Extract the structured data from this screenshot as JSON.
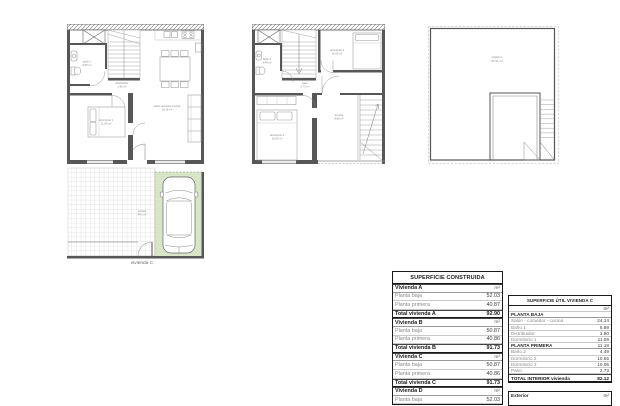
{
  "colors": {
    "wall": "#575757",
    "furniture_line": "#999999",
    "parking_green": "#dbe7cb",
    "label_gray": "#8a8a8a"
  },
  "drawing": {
    "caption": "vivienda C",
    "planta_baja": {
      "bano": [
        "baño 1",
        "5.89 m²"
      ],
      "distribuidor": [
        "distribuidor",
        "1.90 m²"
      ],
      "dormitorio1": [
        "dormitorio 1",
        "11.09 m²"
      ],
      "salon": [
        "salón-comedor-cocina",
        "24.14 m²"
      ]
    },
    "planta_primera": {
      "bano": [
        "baño 2",
        "4.49 m²"
      ],
      "paso": [
        "paso",
        "2.73 m²"
      ],
      "dormitorio3": [
        "dormitorio 3",
        "10.05 m²"
      ],
      "dormitorio2": [
        "dormitorio 2",
        "10.65 m²"
      ],
      "terraza": [
        "terraza",
        "8.86 m²"
      ]
    },
    "solarium": [
      "solárium",
      "31.91 m²"
    ],
    "parcela": [
      "terraza",
      "44.1 m²"
    ]
  },
  "tables": {
    "construida": {
      "title": "SUPERFICIE CONSTRUIDA",
      "unit": "m²",
      "sections": [
        {
          "name": "Vivienda A",
          "rows": [
            {
              "label": "Planta baja",
              "value": "52.03"
            },
            {
              "label": "Planta primera",
              "value": "40.87"
            }
          ],
          "total_label": "Total vivienda A",
          "total_value": "92.90"
        },
        {
          "name": "Vivienda B",
          "rows": [
            {
              "label": "Planta baja",
              "value": "50.87"
            },
            {
              "label": "Planta primera",
              "value": "40.86"
            }
          ],
          "total_label": "Total vivienda B",
          "total_value": "91.73"
        },
        {
          "name": "Vivienda C",
          "rows": [
            {
              "label": "Planta baja",
              "value": "50.87"
            },
            {
              "label": "Planta primera",
              "value": "40.86"
            }
          ],
          "total_label": "Total vivienda C",
          "total_value": "91.73"
        },
        {
          "name": "Vivienda D",
          "rows": [
            {
              "label": "Planta baja",
              "value": "52.03"
            }
          ]
        }
      ]
    },
    "util": {
      "title": "SUPERFICIE ÚTIL VIVIENDA C",
      "unit": "m²",
      "rows": [
        {
          "label": "PLANTA BAJA",
          "value": ""
        },
        {
          "label": "Salón - comedor - cocina",
          "value": "24.14"
        },
        {
          "label": "Baño 1",
          "value": "5.89"
        },
        {
          "label": "Distribuidor",
          "value": "1.90"
        },
        {
          "label": "Dormitorio 1",
          "value": "11.09"
        },
        {
          "label": "PLANTA PRIMERA",
          "value": "11.18"
        },
        {
          "label": "Baño 2",
          "value": "4.49"
        },
        {
          "label": "Dormitorio 2",
          "value": "10.65"
        },
        {
          "label": "Dormitorio 3",
          "value": "10.05"
        },
        {
          "label": "Paso",
          "value": "2.73"
        }
      ],
      "total_label": "TOTAL INTERIOR vivienda",
      "total_value": "82.12",
      "exterior_label": "Exterior",
      "exterior_unit": "m²"
    }
  }
}
